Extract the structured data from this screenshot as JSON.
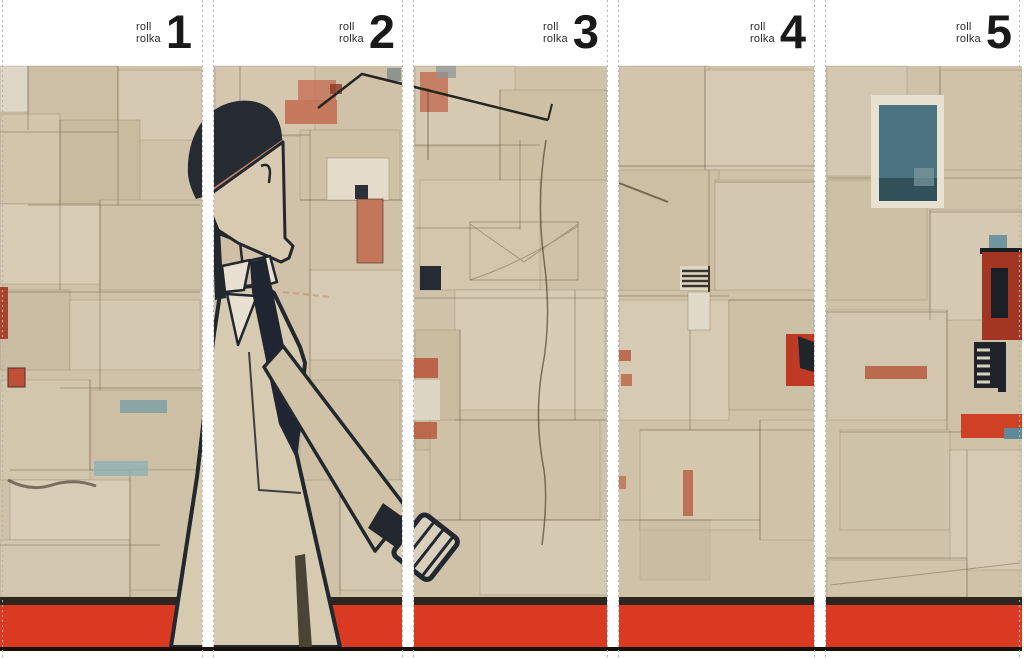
{
  "rolls": [
    {
      "word1": "roll",
      "word2": "rolka",
      "number": "1"
    },
    {
      "word1": "roll",
      "word2": "rolka",
      "number": "2"
    },
    {
      "word1": "roll",
      "word2": "rolka",
      "number": "3"
    },
    {
      "word1": "roll",
      "word2": "rolka",
      "number": "4"
    },
    {
      "word1": "roll",
      "word2": "rolka",
      "number": "5"
    }
  ],
  "palette": {
    "background_beige": "#cfc2a9",
    "floor_red": "#d93a21",
    "floor_shadow": "#2c261d",
    "baseline_black": "#15120c",
    "ink_dark": "#23272e",
    "accent_salmon": "#c4765a",
    "accent_terracotta": "#b5593c",
    "accent_teal": "#4b7280",
    "accent_navy": "#20252c",
    "header_white": "#ffffff",
    "cut_line_gray": "#b3b3b3"
  }
}
